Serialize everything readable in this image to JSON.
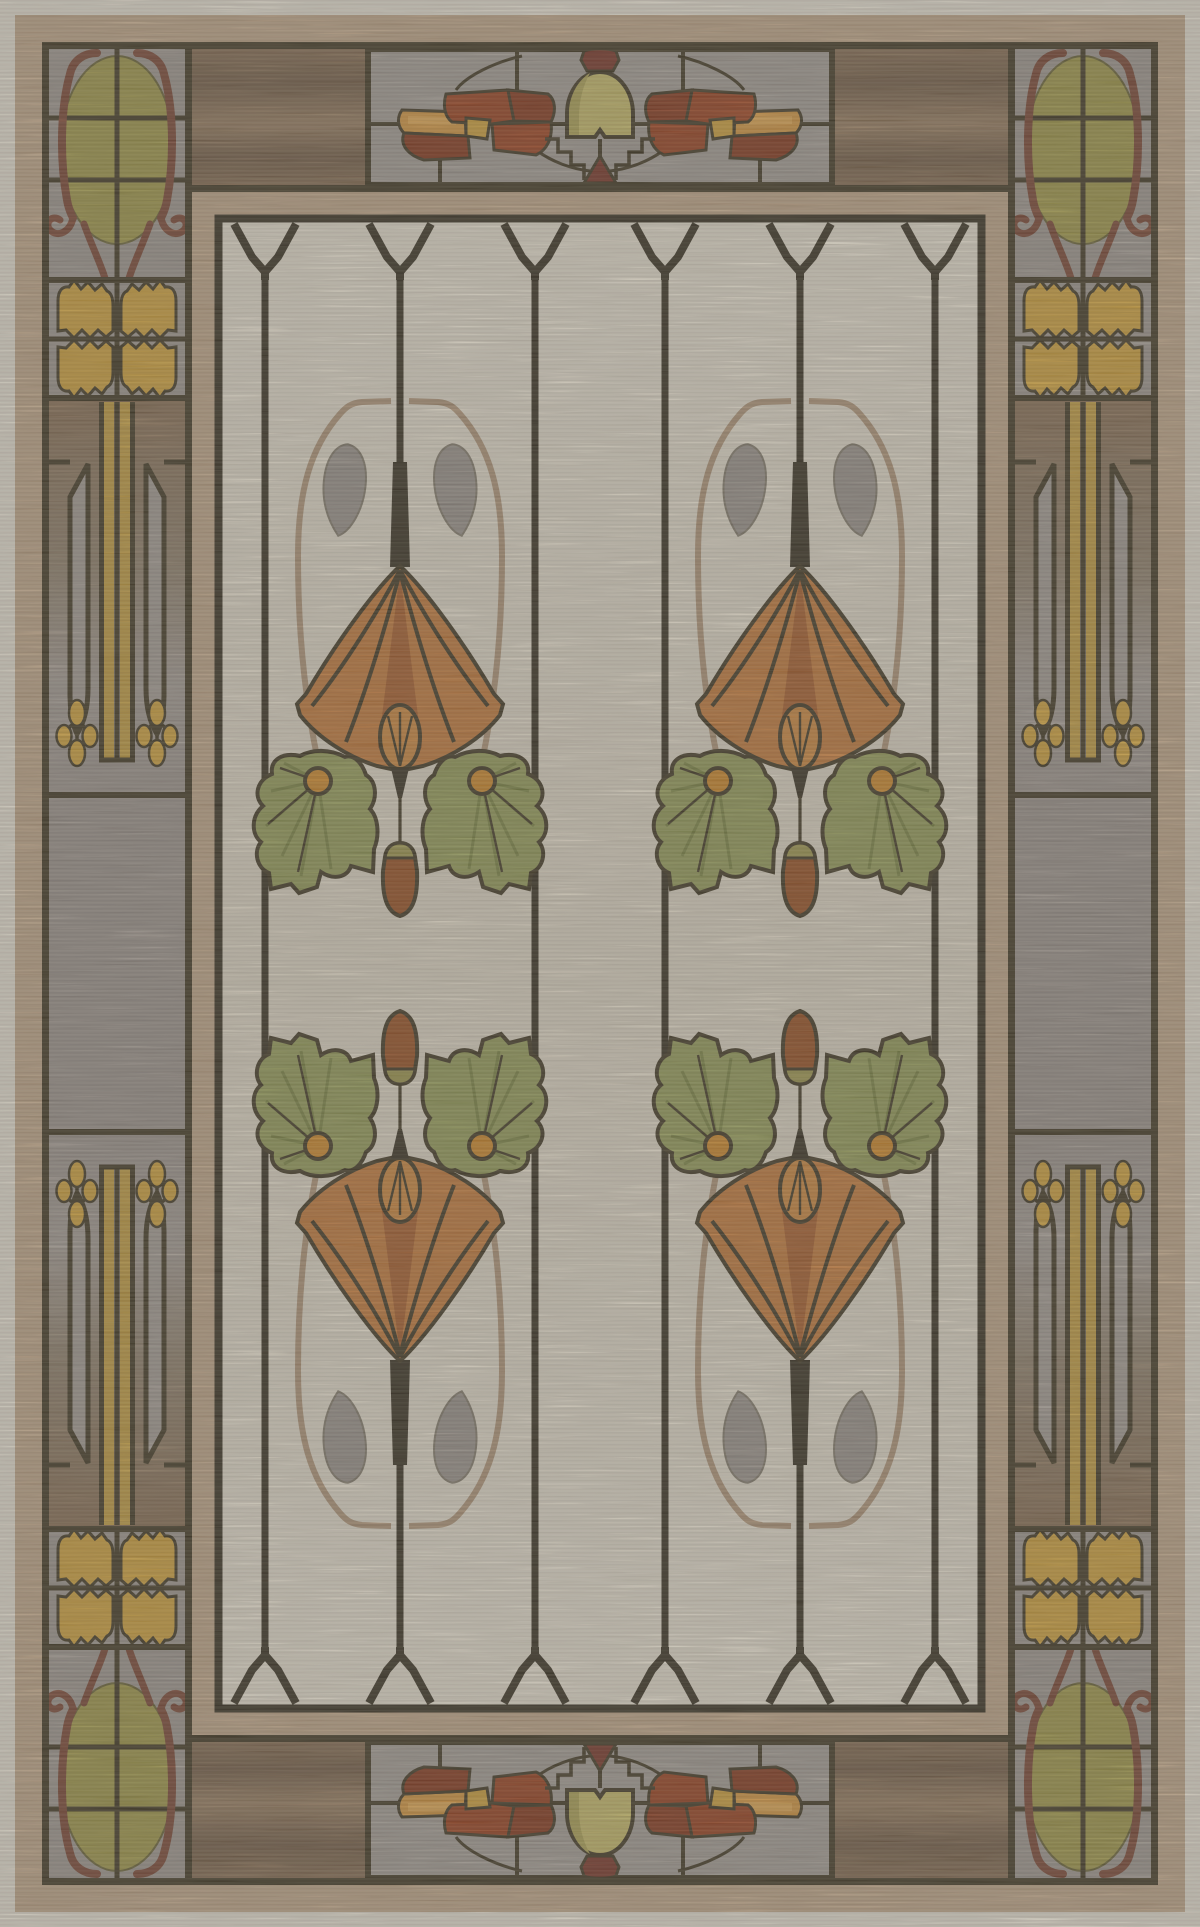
{
  "artwork": {
    "title": "Arts and Crafts stained-glass style area rug",
    "type": "rug product photograph",
    "motifs": {
      "field": "ivory ground with dark mullion lines ending in pointed Y-arches, two mirrored columns of stylized orange fan flowers with green ivy leaves, orange berries, grey teardrop leaves and rust seed pods",
      "top_bottom_panels": "grey glass panel with rust red leaf wings, yellow-green bell and dark red finial",
      "corner_panels": "olive glass oval framed by dark red wrought scrollwork over grey panes",
      "side_panels": "gold tulip floret blocks, twin gold stripes with lance shapes and small gold fleur drops, plain grey center panel"
    }
  },
  "layout": {
    "canvas": {
      "width": 1200,
      "height": 1927
    },
    "field_rect": [
      215,
      215,
      985,
      1712
    ],
    "field_line_x": [
      265,
      400,
      535,
      665,
      800,
      935
    ],
    "flower_column_centers_x": [
      400,
      800
    ],
    "border_band": {
      "left_x": [
        42,
        192
      ],
      "right_x": [
        1008,
        1158
      ],
      "top_y": [
        42,
        185
      ],
      "bottom_y": [
        1742,
        1885
      ]
    }
  },
  "palette": {
    "outline": "#473d28",
    "line_dark": "#3e3626",
    "cream_edge": "#e9e2d3",
    "tan": "#c3a98b",
    "tan_deep": "#b2967a",
    "walnut": "#8b7156",
    "walnut_dark": "#78614a",
    "walnut_light": "#9c8164",
    "gray_panel": "#a8a098",
    "gray_cell": "#a29a92",
    "gray_cell2": "#9f968e",
    "field": "#e7dfcf",
    "field_shade": "#ded5c3",
    "mandorla": "#b2977a",
    "teardrop": "#9d958d",
    "fan": "#c67d3e",
    "fan_dark": "#ab6230",
    "bud": "#cf8a42",
    "leaf": "#989e5c",
    "leaf_dark": "#7f8747",
    "berry": "#d08b2e",
    "pod": "#9c5426",
    "pod_tip": "#a29a52",
    "olive_oval": "#a39a4c",
    "scroll": "#7e4a37",
    "gold": "#d2a440",
    "gold_light": "#e5ab55",
    "rust": "#9d4522",
    "rust_dark": "#8a3c20",
    "orange_patch": "#d89a44",
    "bell": "#c9bc6c",
    "bell_shade": "#b0a458",
    "finial": "#7c392a",
    "stripe_gold": "#c59f45",
    "lance_fill": "#a79e96"
  }
}
